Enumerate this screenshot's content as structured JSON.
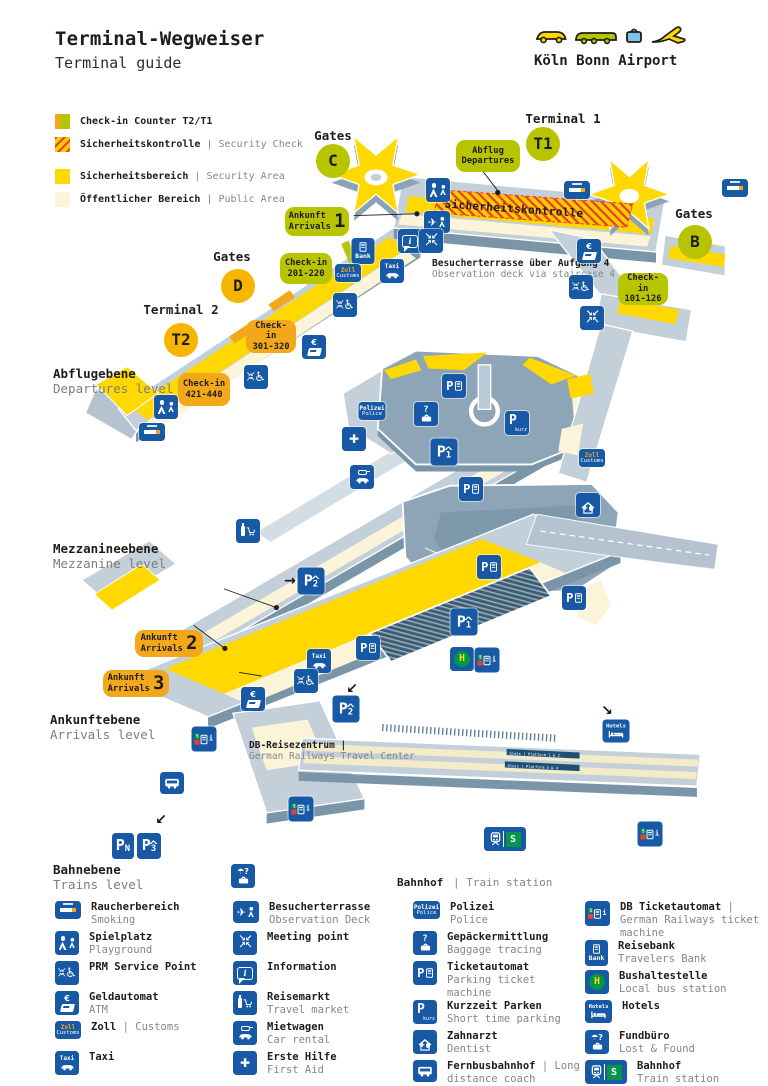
{
  "header": {
    "title": "Terminal-Wegweiser",
    "subtitle": "Terminal guide",
    "brand": "Köln Bonn Airport",
    "logo_icons": [
      "car-icon",
      "bus-icon",
      "bag-icon",
      "plane-icon"
    ]
  },
  "colors": {
    "icon_blue": "#1759a4",
    "lime": "#b8c400",
    "gold": "#f7b500",
    "orange_box": "#f3a71b",
    "security_yellow": "#ffd800",
    "public_cream": "#fbf4d8",
    "hatch_red": "#e8432a",
    "sbahn_green": "#00964b"
  },
  "map_key": {
    "items": [
      {
        "swatch": "checkin",
        "de": "Check-in Counter T2/T1",
        "en": ""
      },
      {
        "swatch": "security-check",
        "de": "Sicherheitskontrolle",
        "en": "| Security Check"
      },
      {
        "swatch": "security-area",
        "de": "Sicherheitsbereich",
        "en": "| Security Area"
      },
      {
        "swatch": "public-area",
        "de": "Öffentlicher Bereich",
        "en": "| Public Area"
      }
    ]
  },
  "map": {
    "levels": [
      {
        "de": "Abflugebene",
        "en": "Departures level"
      },
      {
        "de": "Mezzanineebene",
        "en": "Mezzanine level"
      },
      {
        "de": "Ankunftebene",
        "en": "Arrivals level"
      },
      {
        "de": "Bahnebene",
        "en": "Trains level"
      }
    ],
    "terminals": [
      {
        "label": "Terminal 1",
        "badge": "T1"
      },
      {
        "label": "Terminal 2",
        "badge": "T2"
      }
    ],
    "gates": [
      {
        "label": "Gates",
        "badge": "C"
      },
      {
        "label": "Gates",
        "badge": "B"
      },
      {
        "label": "Gates",
        "badge": "D"
      }
    ],
    "security_band": "Sicherheitskontrolle",
    "callouts": [
      {
        "id": "abflug",
        "lines": [
          "Abflug",
          "Departures"
        ],
        "num": "",
        "color": "lime"
      },
      {
        "id": "ankunft1",
        "lines": [
          "Ankunft",
          "Arrivals"
        ],
        "num": "1",
        "color": "lime"
      },
      {
        "id": "checkin201",
        "lines": [
          "Check-in",
          "201-220"
        ],
        "num": "",
        "color": "lime"
      },
      {
        "id": "checkin101",
        "lines": [
          "Check-in",
          "101-126"
        ],
        "num": "",
        "color": "lime"
      },
      {
        "id": "checkin301",
        "lines": [
          "Check-in",
          "301-320"
        ],
        "num": "",
        "color": "orange"
      },
      {
        "id": "checkin421",
        "lines": [
          "Check-in",
          "421-440"
        ],
        "num": "",
        "color": "orange"
      },
      {
        "id": "ankunft2",
        "lines": [
          "Ankunft",
          "Arrivals"
        ],
        "num": "2",
        "color": "orange"
      },
      {
        "id": "ankunft3",
        "lines": [
          "Ankunft",
          "Arrivals"
        ],
        "num": "3",
        "color": "orange"
      }
    ],
    "annotations": [
      {
        "de": "Besucherterrasse über Aufgang 4",
        "en": "Observation deck via staircase 4"
      },
      {
        "de": "DB-Reisezentrum |",
        "en": "German Railways Travel Center"
      },
      {
        "de": "Bahnhof",
        "en": "| Train station"
      }
    ],
    "platforms": [
      "Gleis | Platform 1 & 2",
      "Gleis | Platform 3 & 4"
    ],
    "markers": [
      {
        "x": 438,
        "y": 190,
        "icon": "playground"
      },
      {
        "x": 577,
        "y": 190,
        "icon": "smoking"
      },
      {
        "x": 735,
        "y": 188,
        "icon": "smoking"
      },
      {
        "x": 437,
        "y": 222,
        "icon": "observation"
      },
      {
        "x": 410,
        "y": 241,
        "icon": "information"
      },
      {
        "x": 431,
        "y": 241,
        "icon": "meeting"
      },
      {
        "x": 363,
        "y": 251,
        "icon": "bank"
      },
      {
        "x": 348,
        "y": 273,
        "icon": "zoll"
      },
      {
        "x": 392,
        "y": 271,
        "icon": "taxi"
      },
      {
        "x": 589,
        "y": 251,
        "icon": "atm"
      },
      {
        "x": 581,
        "y": 287,
        "icon": "prm"
      },
      {
        "x": 592,
        "y": 318,
        "icon": "meeting"
      },
      {
        "x": 345,
        "y": 305,
        "icon": "prm"
      },
      {
        "x": 314,
        "y": 347,
        "icon": "atm"
      },
      {
        "x": 256,
        "y": 377,
        "icon": "prm"
      },
      {
        "x": 166,
        "y": 407,
        "icon": "playground"
      },
      {
        "x": 152,
        "y": 432,
        "icon": "smoking"
      },
      {
        "x": 372,
        "y": 411,
        "icon": "polizei"
      },
      {
        "x": 426,
        "y": 414,
        "icon": "gepaeck"
      },
      {
        "x": 454,
        "y": 386,
        "icon": "pauto"
      },
      {
        "x": 517,
        "y": 423,
        "icon": "pkurz"
      },
      {
        "x": 444,
        "y": 452,
        "icon": "p1"
      },
      {
        "x": 354,
        "y": 439,
        "icon": "erstehilfe"
      },
      {
        "x": 362,
        "y": 477,
        "icon": "mietwagen"
      },
      {
        "x": 471,
        "y": 489,
        "icon": "pauto"
      },
      {
        "x": 592,
        "y": 458,
        "icon": "zoll"
      },
      {
        "x": 588,
        "y": 505,
        "icon": "zahnarzt"
      },
      {
        "x": 248,
        "y": 531,
        "icon": "reisemarkt"
      },
      {
        "x": 290,
        "y": 581,
        "icon": "arrow-right"
      },
      {
        "x": 311,
        "y": 581,
        "icon": "p2"
      },
      {
        "x": 489,
        "y": 567,
        "icon": "pauto"
      },
      {
        "x": 574,
        "y": 598,
        "icon": "pauto"
      },
      {
        "x": 368,
        "y": 648,
        "icon": "pauto"
      },
      {
        "x": 319,
        "y": 661,
        "icon": "taxi"
      },
      {
        "x": 306,
        "y": 681,
        "icon": "prm"
      },
      {
        "x": 253,
        "y": 699,
        "icon": "atm"
      },
      {
        "x": 352,
        "y": 689,
        "icon": "arrow-sw"
      },
      {
        "x": 346,
        "y": 709,
        "icon": "p2"
      },
      {
        "x": 464,
        "y": 622,
        "icon": "p1"
      },
      {
        "x": 462,
        "y": 659,
        "icon": "bushalte"
      },
      {
        "x": 487,
        "y": 660,
        "icon": "dbauto"
      },
      {
        "x": 204,
        "y": 739,
        "icon": "dbauto"
      },
      {
        "x": 607,
        "y": 711,
        "icon": "arrow-se"
      },
      {
        "x": 616,
        "y": 731,
        "icon": "hotels"
      },
      {
        "x": 172,
        "y": 783,
        "icon": "bus"
      },
      {
        "x": 161,
        "y": 820,
        "icon": "arrow-sw"
      },
      {
        "x": 123,
        "y": 846,
        "icon": "pn"
      },
      {
        "x": 149,
        "y": 846,
        "icon": "p3"
      },
      {
        "x": 243,
        "y": 876,
        "icon": "fundbuero"
      },
      {
        "x": 301,
        "y": 809,
        "icon": "dbauto"
      },
      {
        "x": 505,
        "y": 839,
        "icon": "bahnhof"
      },
      {
        "x": 650,
        "y": 834,
        "icon": "dbauto"
      }
    ]
  },
  "legend": {
    "columns": [
      [
        {
          "icon": "smoking",
          "de": "Raucherbereich",
          "en": "Smoking"
        },
        {
          "icon": "playground",
          "de": "Spielplatz",
          "en": "Playground"
        },
        {
          "icon": "prm",
          "de": "PRM Service Point",
          "en": ""
        },
        {
          "icon": "atm",
          "de": "Geldautomat",
          "en": "ATM"
        },
        {
          "icon": "zoll",
          "de": "Zoll",
          "en": "| Customs",
          "inline": true
        },
        {
          "icon": "taxi",
          "de": "Taxi",
          "en": ""
        }
      ],
      [
        {
          "icon": "observation",
          "de": "Besucherterrasse",
          "en": "Observation Deck"
        },
        {
          "icon": "meeting",
          "de": "Meeting point",
          "en": ""
        },
        {
          "icon": "information",
          "de": "Information",
          "en": ""
        },
        {
          "icon": "reisemarkt",
          "de": "Reisemarkt",
          "en": "Travel market"
        },
        {
          "icon": "mietwagen",
          "de": "Mietwagen",
          "en": "Car rental"
        },
        {
          "icon": "erstehilfe",
          "de": "Erste Hilfe",
          "en": "First Aid"
        }
      ],
      [
        {
          "icon": "polizei",
          "de": "Polizei",
          "en": "Police"
        },
        {
          "icon": "gepaeck",
          "de": "Gepäckermittlung",
          "en": "Baggage tracing"
        },
        {
          "icon": "pauto",
          "de": "Ticketautomat",
          "en": "Parking ticket machine"
        },
        {
          "icon": "pkurz",
          "de": "Kurzzeit Parken",
          "en": "Short time parking"
        },
        {
          "icon": "zahnarzt",
          "de": "Zahnarzt",
          "en": "Dentist"
        },
        {
          "icon": "bus",
          "de": "Fernbusbahnhof",
          "en": "| Long distance coach terminal",
          "inline": true
        }
      ],
      [
        {
          "icon": "dbauto",
          "de": "DB Ticketautomat",
          "en": "| German Railways ticket machine",
          "inline": true
        },
        {
          "icon": "bank",
          "de": "Reisebank",
          "en": "Travelers Bank"
        },
        {
          "icon": "bushalte",
          "de": "Bushaltestelle",
          "en": "Local bus station"
        },
        {
          "icon": "hotels",
          "de": "Hotels",
          "en": ""
        },
        {
          "icon": "fundbuero",
          "de": "Fundbüro",
          "en": "Lost & Found"
        },
        {
          "icon": "bahnhof",
          "de": "Bahnhof",
          "en": "Train station"
        }
      ]
    ]
  }
}
